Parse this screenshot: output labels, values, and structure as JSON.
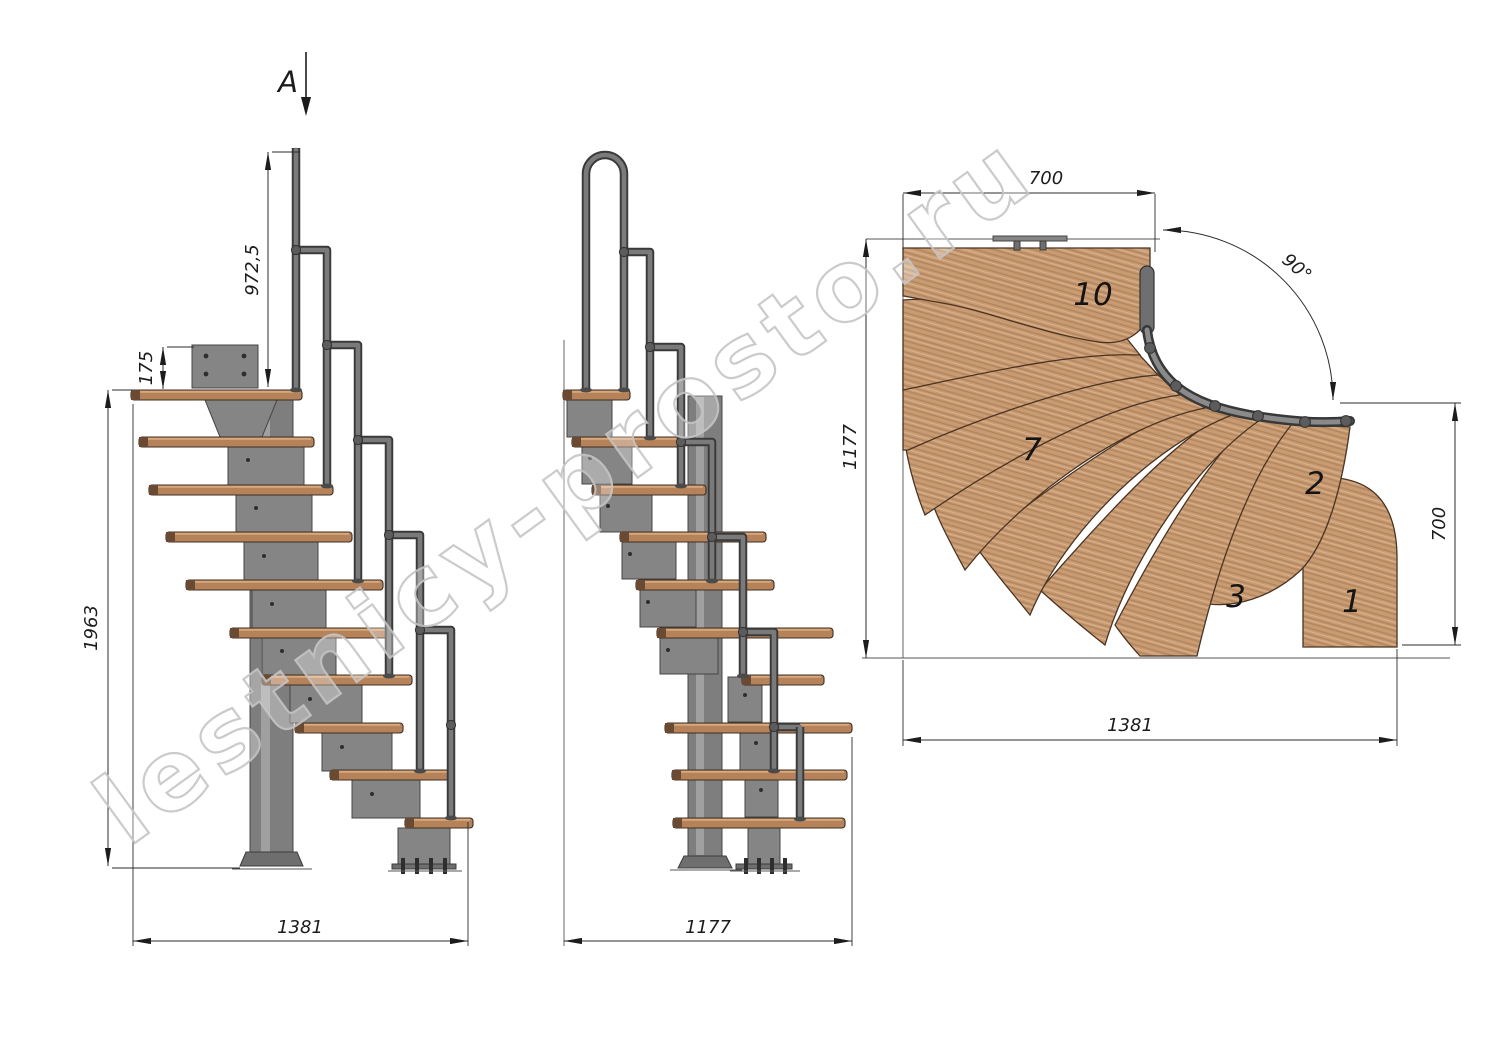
{
  "watermark": {
    "text": "lestnicy-prosto.ru"
  },
  "section_marker": {
    "label": "A"
  },
  "side_view": {
    "dims": {
      "total_height": "1963",
      "plate_offset": "175",
      "handrail_height": "972,5",
      "base_length": "1381"
    }
  },
  "front_view": {
    "dims": {
      "base_length": "1177"
    }
  },
  "plan_view": {
    "dims": {
      "top_width": "700",
      "left_depth": "1177",
      "right_depth": "700",
      "total_length": "1381",
      "turn_angle": "90°"
    },
    "step_numbers": {
      "s10": "10",
      "s7": "7",
      "s2": "2",
      "s3": "3",
      "s1": "1"
    }
  },
  "colors": {
    "wood_plan": "#c99b72",
    "wood_side": "#b5825a",
    "metal": "#7e7e7e",
    "line": "#1f1f1f",
    "watermark_stroke": "#c6c6c6",
    "background": "#ffffff"
  }
}
